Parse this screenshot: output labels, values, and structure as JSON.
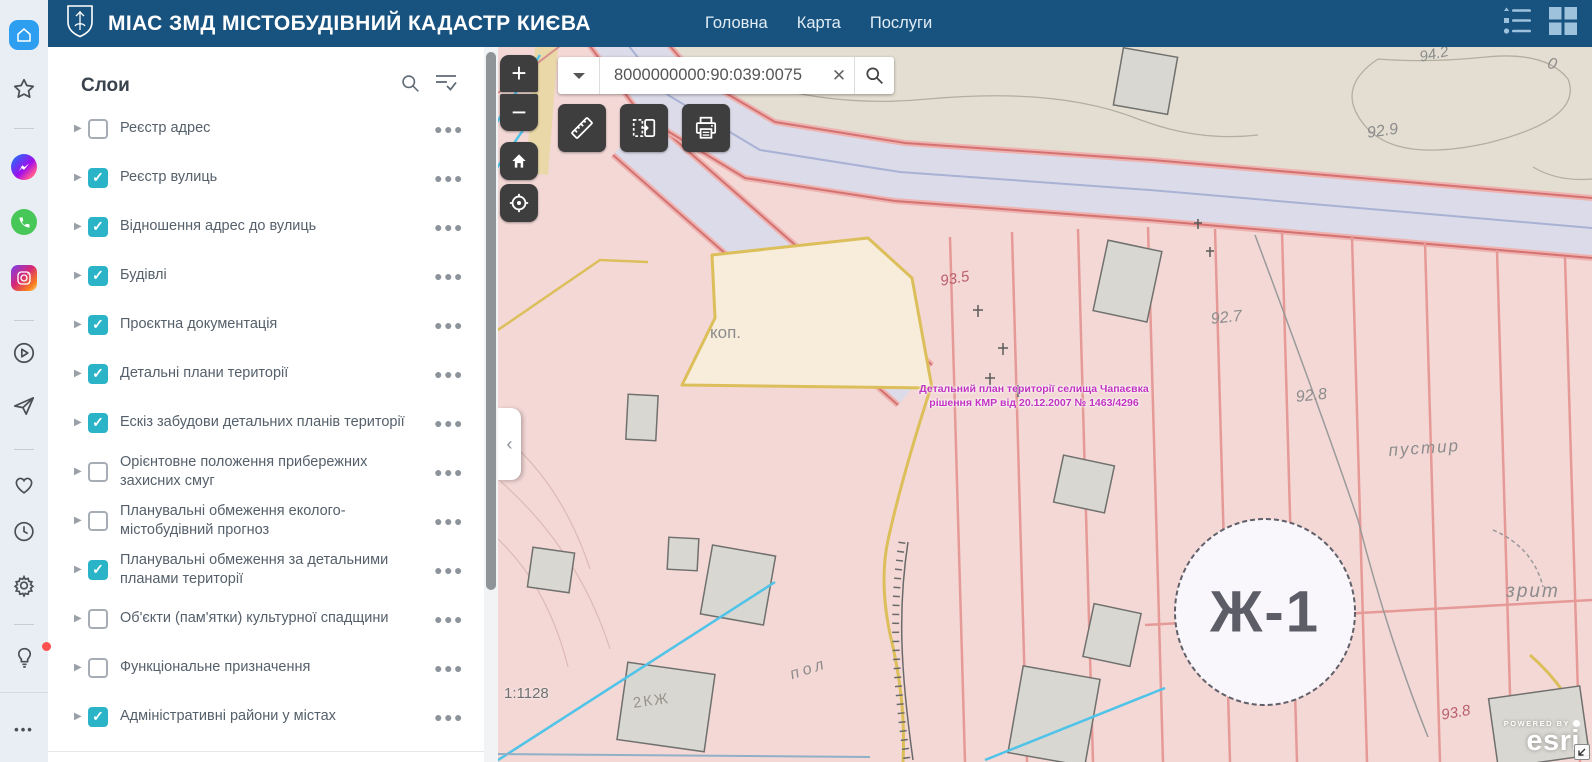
{
  "browser_sidebar": {
    "icons": [
      "speed-dial-home",
      "bookmarks-star",
      "messenger",
      "whatsapp",
      "instagram",
      "video-popout",
      "my-flow-send",
      "favorites-heart",
      "history-clock",
      "settings-gear",
      "setup-bulb",
      "sidebar-more"
    ]
  },
  "header": {
    "title": "МІАС ЗМД МІСТОБУДІВНИЙ КАДАСТР КИЄВА",
    "nav": [
      "Головна",
      "Карта",
      "Послуги"
    ],
    "right_icons": [
      "legend-icon",
      "apps-grid-icon"
    ]
  },
  "layers_panel": {
    "title": "Слои",
    "icons": [
      "search-icon",
      "filter-list-icon"
    ],
    "layers": [
      {
        "label": "Реєстр адрес",
        "checked": false
      },
      {
        "label": "Реєстр вулиць",
        "checked": true
      },
      {
        "label": "Відношення адрес до вулиць",
        "checked": true
      },
      {
        "label": "Будівлі",
        "checked": true
      },
      {
        "label": "Проєктна документація",
        "checked": true
      },
      {
        "label": "Детальні плани території",
        "checked": true
      },
      {
        "label": "Ескіз забудови детальних планів території",
        "checked": true
      },
      {
        "label": "Орієнтовне положення прибережних\nзахисних смуг",
        "checked": false
      },
      {
        "label": "Планувальні обмеження еколого-\nмістобудівний прогноз",
        "checked": false
      },
      {
        "label": "Планувальні обмеження за детальними\nпланами території",
        "checked": true
      },
      {
        "label": "Об'єкти (пам'ятки) культурної спадщини",
        "checked": false
      },
      {
        "label": "Функціональне призначення",
        "checked": false
      },
      {
        "label": "Адміністративні райони у містах",
        "checked": true
      }
    ]
  },
  "map": {
    "search": {
      "value": "8000000000:90:039:0075"
    },
    "tools": [
      "measure",
      "swipe",
      "print"
    ],
    "controls": [
      "zoom-in",
      "zoom-out",
      "home",
      "locate"
    ],
    "scale_label": "1:1128",
    "annotation": {
      "line1": "Детальний план території селища Чапаєвка",
      "line2": "рішення КМР від 20.12.2007 № 1463/4296",
      "color": "#c233c2"
    },
    "attribution": {
      "powered_by": "POWERED BY",
      "brand": "esri"
    },
    "labels": [
      {
        "text": "коп.",
        "x": 212,
        "y": 276,
        "size": 17,
        "color": "#8c8c8c"
      },
      {
        "text": "93.5",
        "x": 441,
        "y": 226,
        "size": 15,
        "color": "#b95f6b",
        "italic": true,
        "rotate": -10
      },
      {
        "text": "92.7",
        "x": 712,
        "y": 264,
        "size": 16,
        "color": "#8c8c8c",
        "italic": true,
        "rotate": -6
      },
      {
        "text": "92.8",
        "x": 797,
        "y": 342,
        "size": 16,
        "color": "#8c8c8c",
        "italic": true,
        "rotate": -6
      },
      {
        "text": "92.9",
        "x": 868,
        "y": 78,
        "size": 16,
        "color": "#8c8c8c",
        "italic": true,
        "rotate": -8
      },
      {
        "text": "94.2",
        "x": 920,
        "y": 2,
        "size": 15,
        "color": "#8c8c8c",
        "italic": true,
        "rotate": -12
      },
      {
        "text": "пустир",
        "x": 890,
        "y": 394,
        "size": 17,
        "color": "#8c8c8c",
        "italic": true,
        "ls": 2,
        "rotate": -4
      },
      {
        "text": "зрит",
        "x": 1008,
        "y": 534,
        "size": 19,
        "color": "#8c8c8c",
        "italic": true,
        "ls": 2
      },
      {
        "text": "93.8",
        "x": 942,
        "y": 660,
        "size": 15,
        "color": "#b95f6b",
        "italic": true,
        "rotate": -10
      },
      {
        "text": "пол",
        "x": 290,
        "y": 620,
        "size": 16,
        "color": "#8c8c8c",
        "italic": true,
        "ls": 4,
        "rotate": -18
      },
      {
        "text": "2КЖ",
        "x": 134,
        "y": 648,
        "size": 15,
        "color": "#98948c",
        "ls": 2,
        "rotate": -8
      },
      {
        "text": "0",
        "x": 1052,
        "y": 8,
        "size": 16,
        "color": "#8c8c8c",
        "italic": true,
        "rotate": 15
      },
      {
        "text": "Ж-1",
        "x": 767,
        "y": 565,
        "size": 58,
        "color": "#5d5d68",
        "bold": true,
        "ls": 2,
        "center": true
      }
    ]
  }
}
